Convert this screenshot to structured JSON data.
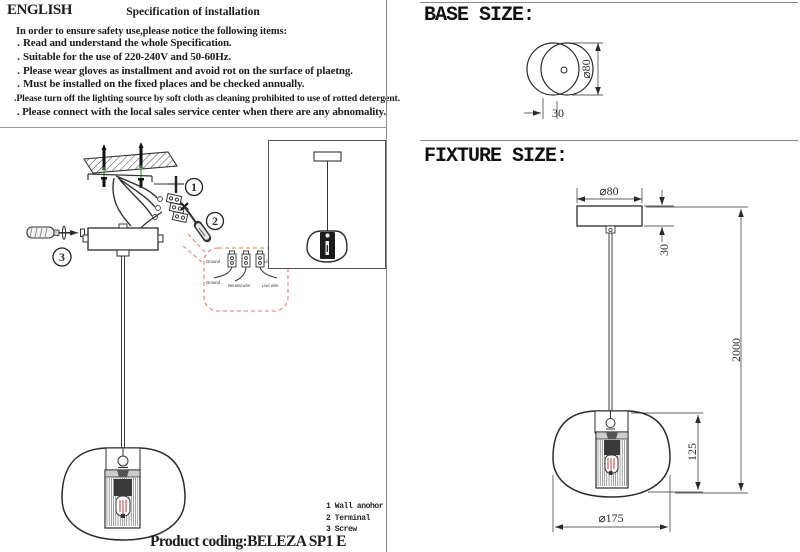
{
  "colors": {
    "line": "#2b2b2b",
    "rule_gray": "#9a9a9a",
    "callout_dash": "#e59385",
    "anchor_green": "#3fa33f",
    "bulb_red": "#b04030"
  },
  "left_panel": {
    "language_label": "ENGLISH",
    "title": "Specification of installation",
    "intro": "In order to ensure safety use,please notice the following items:",
    "bullet": ".",
    "items": [
      "Read and understand the whole Specification.",
      "Suitable for the use of 220-240V and 50-60Hz.",
      "Please wear gloves as installment and avoid rot on the surface of plaetng.",
      "Must be installed on the fixed places and be checked annually.",
      "Please turn off the lighting source by soft cloth as cleaning prohibited to use of rotted detergent.",
      "Please connect with the local sales service center when there are any abnomality."
    ],
    "step_markers": [
      "1",
      "2",
      "3"
    ],
    "callout_labels": [
      "Ground",
      "Live wire",
      "Ground",
      "Neutral wire",
      "Live wire"
    ],
    "legend": [
      "1 Wall anohor",
      "2 Terminal",
      "3 Screw"
    ],
    "product_coding": "Product coding:BELEZA SP1 E"
  },
  "right_panel": {
    "base_title": "BASE SIZE:",
    "fixture_title": "FIXTURE SIZE:",
    "base_dims": {
      "diameter": "⌀80",
      "depth": "30"
    },
    "fixture_dims": {
      "canopy_diameter": "⌀80",
      "canopy_height": "30",
      "overall_length": "2000",
      "shade_height": "125",
      "shade_diameter": "⌀175"
    }
  }
}
